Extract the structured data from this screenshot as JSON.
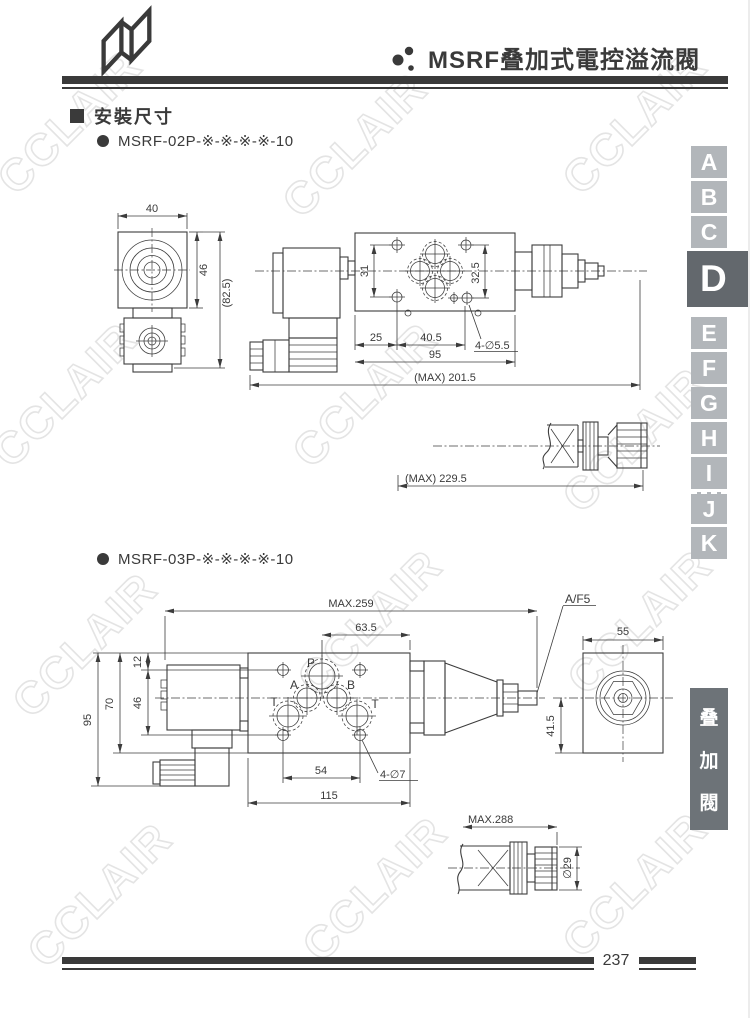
{
  "watermark": {
    "text": "CCLAIR"
  },
  "header": {
    "title": "MSRF叠加式電控溢流閥"
  },
  "section": {
    "heading": "安裝尺寸"
  },
  "models": {
    "m02": "MSRF-02P-※-※-※-※-10",
    "m03": "MSRF-03P-※-※-※-※-10"
  },
  "d02": {
    "dim_40": "40",
    "dim_46": "46",
    "dim_82_5": "(82.5)",
    "dim_31": "31",
    "dim_32_5": "32.5",
    "dim_25": "25",
    "dim_40_5": "40.5",
    "dim_95": "95",
    "holes": "4-∅5.5",
    "max_total": "(MAX) 201.5",
    "max_knob": "(MAX) 229.5"
  },
  "d03": {
    "max_total": "MAX.259",
    "dim_63_5": "63.5",
    "dim_12": "12",
    "dim_46": "46",
    "dim_70": "70",
    "dim_95": "95",
    "dim_54": "54",
    "dim_115": "115",
    "holes": "4-∅7",
    "wrench": "A/F5",
    "dim_55": "55",
    "dim_41_5": "41.5",
    "max_knob": "MAX.288",
    "knob_dia": "∅29",
    "ports": {
      "p": "P",
      "a": "A",
      "b": "B",
      "t_left": "T",
      "t_right": "T"
    }
  },
  "sidebar": {
    "tabs": [
      {
        "letter": "A"
      },
      {
        "letter": "B"
      },
      {
        "letter": "C"
      },
      {
        "letter": "D"
      },
      {
        "letter": "E"
      },
      {
        "letter": "F"
      },
      {
        "letter": "G"
      },
      {
        "letter": "H"
      },
      {
        "letter": "I"
      },
      {
        "letter": "J"
      },
      {
        "letter": "K"
      }
    ],
    "category": {
      "chars": [
        "叠",
        "加",
        "閥"
      ]
    }
  },
  "footer": {
    "page_number": "237"
  }
}
